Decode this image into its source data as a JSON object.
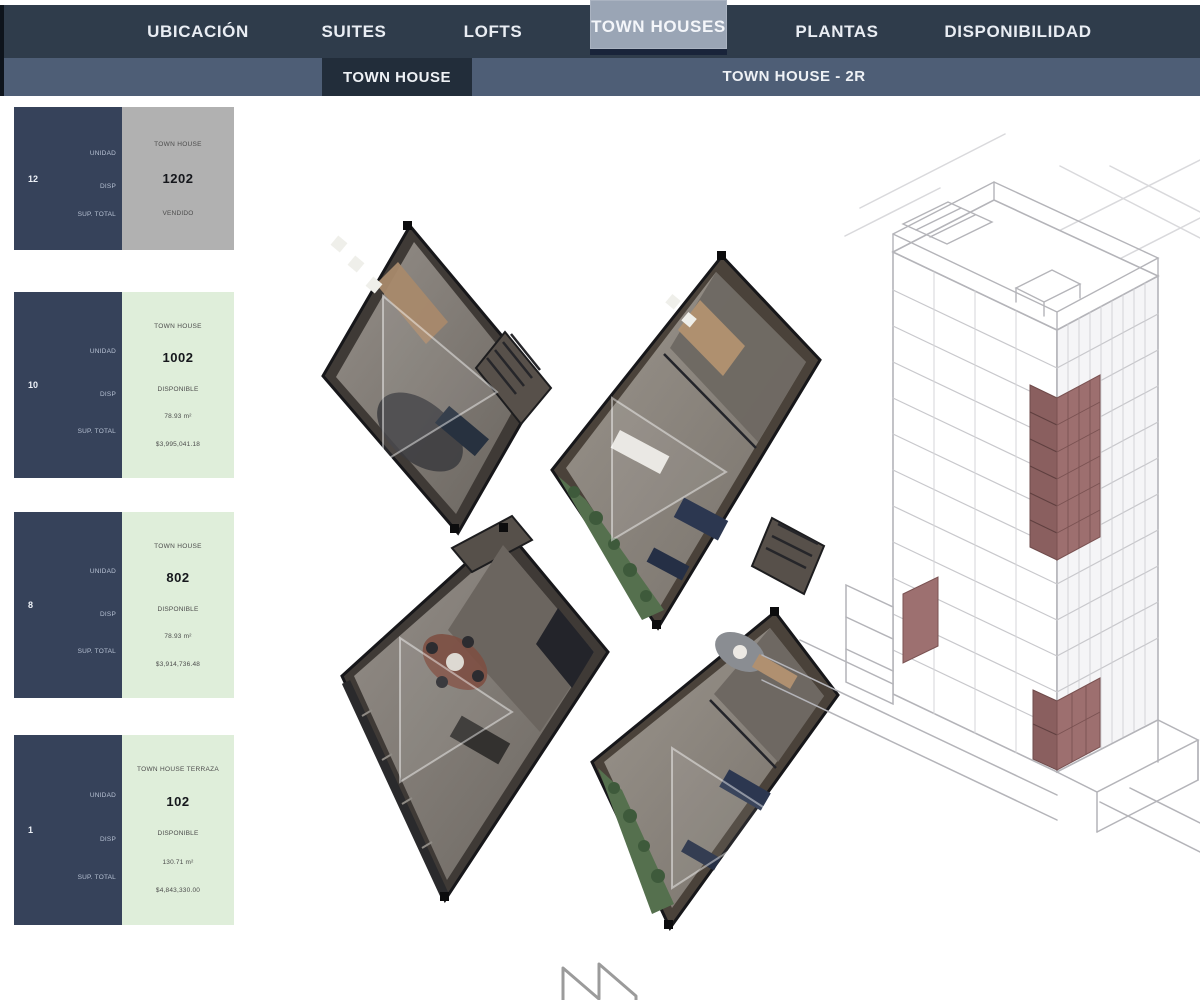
{
  "header": {
    "nav_items": [
      {
        "label": "UBICACIÓN"
      },
      {
        "label": "SUITES"
      },
      {
        "label": "LOFTS"
      },
      {
        "label": "TOWN HOUSES"
      },
      {
        "label": "PLANTAS"
      },
      {
        "label": "DISPONIBILIDAD"
      }
    ],
    "active_nav": "TOWN HOUSES",
    "subnav_items": [
      {
        "label": "TOWN HOUSE"
      },
      {
        "label": "TOWN HOUSE - 2R"
      }
    ],
    "active_subnav": "TOWN HOUSE"
  },
  "card_labels": {
    "unit": "UNIDAD",
    "status": "DISP",
    "area": "SUP. TOTAL"
  },
  "units": [
    {
      "floor": "12",
      "type": "TOWN HOUSE",
      "number": "1202",
      "status": "VENDIDO",
      "availability": "sold"
    },
    {
      "floor": "10",
      "type": "TOWN HOUSE",
      "number": "1002",
      "status": "DISPONIBLE",
      "area": "78.93 m²",
      "price": "$3,995,041.18",
      "availability": "available"
    },
    {
      "floor": "8",
      "type": "TOWN HOUSE",
      "number": "802",
      "status": "DISPONIBLE",
      "area": "78.93 m²",
      "price": "$3,914,736.48",
      "availability": "available"
    },
    {
      "floor": "1",
      "type": "TOWN HOUSE TERRAZA",
      "number": "102",
      "status": "DISPONIBLE",
      "area": "130.71 m²",
      "price": "$4,843,330.00",
      "availability": "available"
    }
  ],
  "colors": {
    "nav_bg": "#2f3c4b",
    "subnav_bg": "#4e5e76",
    "active_tab_bg": "#9aa5b5",
    "active_subtab_bg": "#222d3a",
    "card_navy": "#36425a",
    "available_green": "#dfeeda",
    "sold_gray": "#b1b1b1",
    "highlight_maroon": "#9d6f6f"
  }
}
